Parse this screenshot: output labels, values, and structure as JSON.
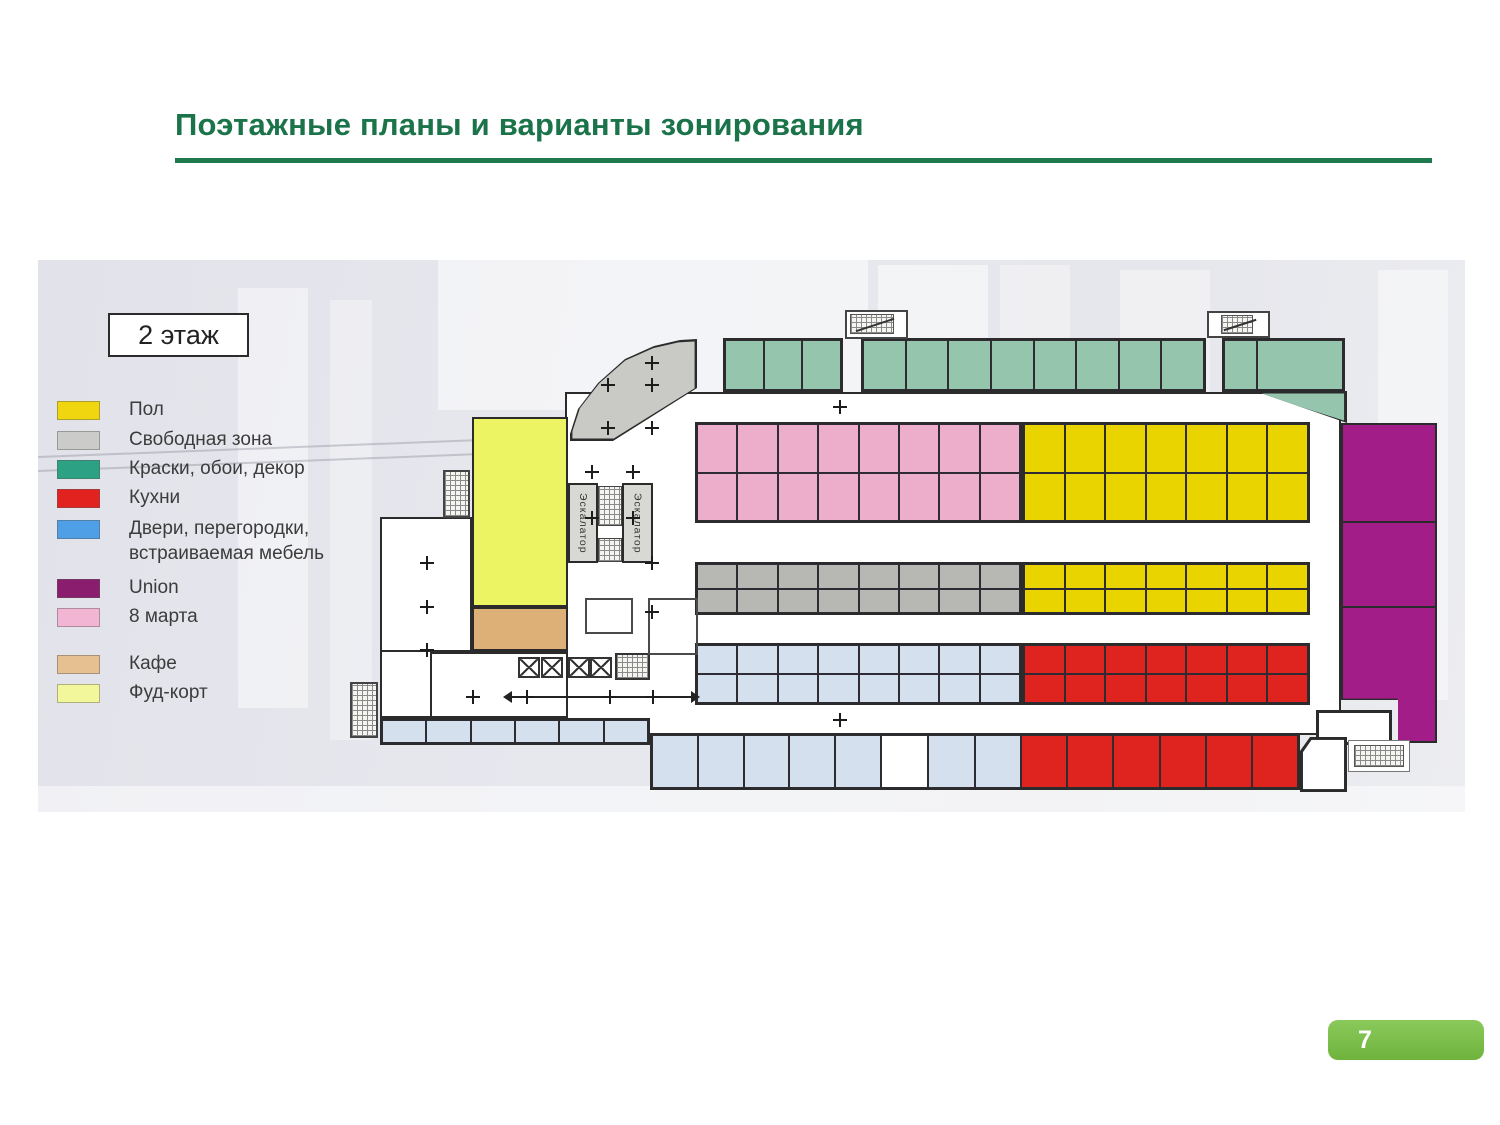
{
  "slide": {
    "title": "Поэтажные планы и варианты зонирования",
    "page_number": "7"
  },
  "colors": {
    "title_green": "#1b734a",
    "rule_green": "#1e7a4e",
    "badge_green": "#7cbf4a",
    "panel_background": "#e6e7ee",
    "wall_dark": "#2b2b2b"
  },
  "plan": {
    "floor_label": "2 этаж",
    "escalators": {
      "left": "Эскалатор",
      "right": "Эскалатор"
    },
    "legend": [
      {
        "label": "Пол",
        "zone": "pol",
        "color": "#f0d60e"
      },
      {
        "label": "Свободная зона",
        "zone": "free",
        "color": "#cbcbc9"
      },
      {
        "label": "Краски, обои, декор",
        "zone": "paints",
        "color": "#2da183"
      },
      {
        "label": "Кухни",
        "zone": "kitchens",
        "color": "#e1221f"
      },
      {
        "label": "Двери, перегородки, встраиваемая мебель",
        "zone": "doors",
        "color": "#4f9fe6"
      },
      {
        "label": "Union",
        "zone": "union",
        "color": "#8a1d6e"
      },
      {
        "label": "8 марта",
        "zone": "march8",
        "color": "#f3b5d4"
      },
      {
        "label": "Кафе",
        "zone": "cafe",
        "color": "#e6c091"
      },
      {
        "label": "Фуд-корт",
        "zone": "foodcourt",
        "color": "#f3f79b"
      }
    ],
    "zones": {
      "pol": {
        "name": "Пол",
        "plan_color": "#e9d400"
      },
      "free": {
        "name": "Свободная зона",
        "plan_color": "#b7b8b4"
      },
      "free_band": {
        "name": "Свободная зона",
        "plan_color": "#c9c9c6"
      },
      "paints": {
        "name": "Краски, обои, декор",
        "plan_color": "#95c5ad"
      },
      "kitchens": {
        "name": "Кухни",
        "plan_color": "#df241f"
      },
      "doors": {
        "name": "Двери, перегородки, встраиваемая мебель",
        "plan_color": "#d4e0ee"
      },
      "union": {
        "name": "Union",
        "plan_color": "#a21d87"
      },
      "march8": {
        "name": "8 марта",
        "plan_color": "#ecaecb"
      },
      "cafe": {
        "name": "Кафе",
        "plan_color": "#ddb077"
      },
      "foodcourt": {
        "name": "Фуд-корт",
        "plan_color": "#edf464"
      },
      "white": {
        "name": "",
        "plan_color": "#ffffff"
      }
    },
    "grids": {
      "tealA": {
        "zone": "paints",
        "cols": 3,
        "rows": 1
      },
      "tealB": {
        "zone": "paints",
        "cols": 8,
        "rows": 1
      },
      "tealC": {
        "zone": "paints",
        "cols": 2,
        "rows": 1,
        "template": "33px 1fr"
      },
      "b1pink": {
        "zone": "march8",
        "cols": 8,
        "rows": 2
      },
      "b1yel": {
        "zone": "pol",
        "cols": 7,
        "rows": 2
      },
      "b2gray": {
        "zone": "free",
        "cols": 8,
        "rows": 2
      },
      "b2yel": {
        "zone": "pol",
        "cols": 7,
        "rows": 2
      },
      "b3blue": {
        "zone": "doors",
        "cols": 8,
        "rows": 2
      },
      "b3red": {
        "zone": "kitchens",
        "cols": 7,
        "rows": 2
      },
      "stripA": {
        "zone": "doors",
        "cols": 6,
        "rows": 1
      },
      "stripB1": {
        "zone": "doors",
        "cols": 5,
        "rows": 1
      },
      "stripBw": {
        "zone": "white",
        "cols": 1,
        "rows": 1
      },
      "stripB2": {
        "zone": "doors",
        "cols": 2,
        "rows": 1
      },
      "stripBred": {
        "zone": "kitchens",
        "cols": 6,
        "rows": 1
      }
    }
  }
}
